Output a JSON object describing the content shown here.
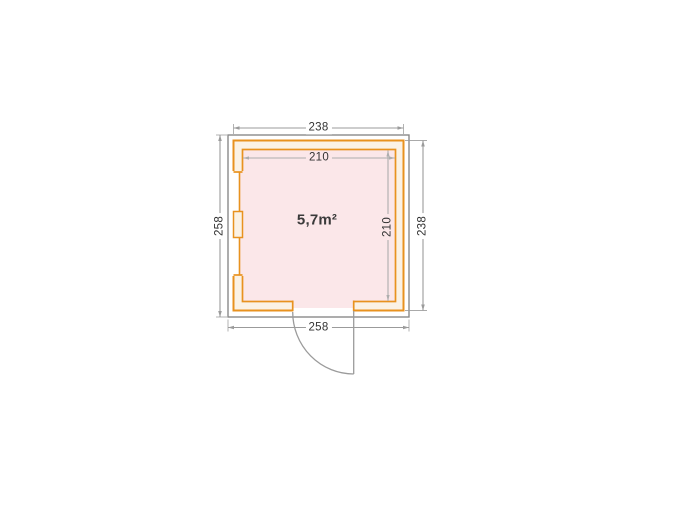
{
  "diagram": {
    "type": "floor-plan",
    "area_label": "5,7m²",
    "dimensions": {
      "wall_width_top": "238",
      "wall_height_right": "238",
      "base_width_bottom": "258",
      "base_height_left": "258",
      "inner_width": "210",
      "inner_height": "210"
    },
    "features": {
      "door": "door-opening-bottom-with-swing-arc",
      "window": "left-wall-window-section-with-mullion"
    },
    "colors": {
      "wall_stroke": "#E8921F",
      "wall_fill": "#FBF2E5",
      "floor_fill": "#FBE7E9",
      "outline_gray": "#8A8A8A",
      "dim_line": "#9B9B9B",
      "dim_line_light": "#ADADAD",
      "door_line": "#9B9B9B",
      "text": "#333333"
    }
  }
}
